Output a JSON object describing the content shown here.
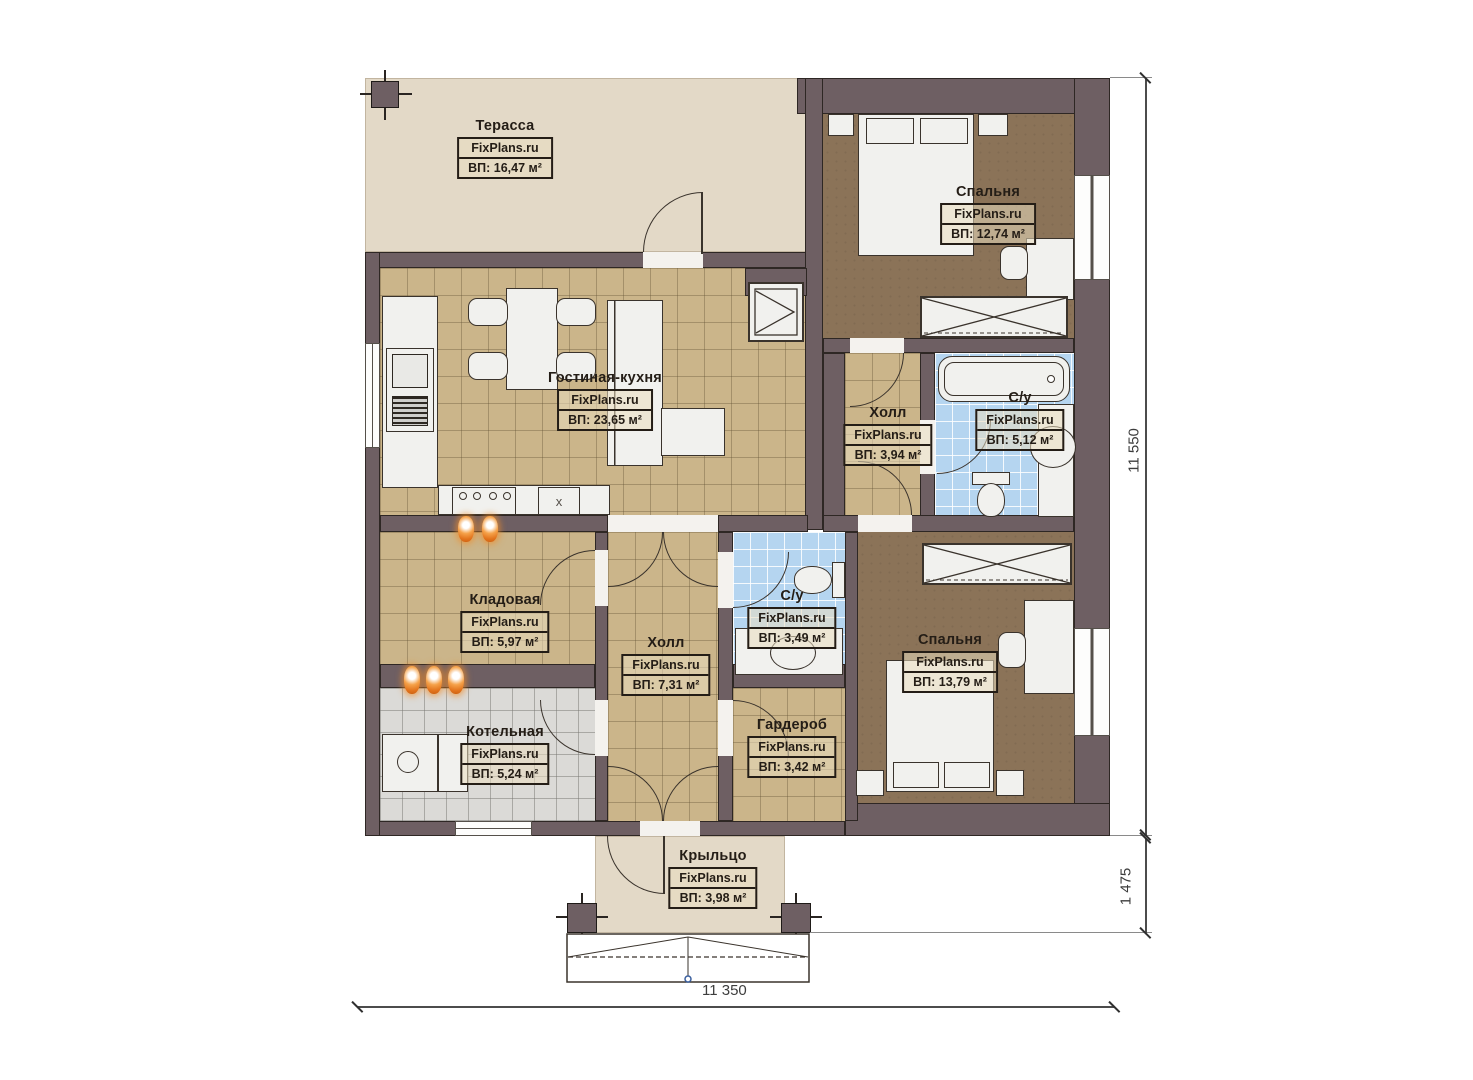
{
  "plan": {
    "rooms": [
      {
        "name": "Терасса",
        "watermark": "FixPlans.ru",
        "area": "ВП: 16,47 м²"
      },
      {
        "name": "Спальня",
        "watermark": "FixPlans.ru",
        "area": "ВП: 12,74 м²"
      },
      {
        "name": "Гостиная-кухня",
        "watermark": "FixPlans.ru",
        "area": "ВП: 23,65 м²"
      },
      {
        "name": "Холл",
        "watermark": "FixPlans.ru",
        "area": "ВП: 3,94 м²"
      },
      {
        "name": "С/у",
        "watermark": "FixPlans.ru",
        "area": "ВП: 5,12 м²"
      },
      {
        "name": "Кладовая",
        "watermark": "FixPlans.ru",
        "area": "ВП: 5,97 м²"
      },
      {
        "name": "Холл",
        "watermark": "FixPlans.ru",
        "area": "ВП: 7,31 м²"
      },
      {
        "name": "С/у",
        "watermark": "FixPlans.ru",
        "area": "ВП: 3,49 м²"
      },
      {
        "name": "Котельная",
        "watermark": "FixPlans.ru",
        "area": "ВП: 5,24 м²"
      },
      {
        "name": "Гардероб",
        "watermark": "FixPlans.ru",
        "area": "ВП: 3,42 м²"
      },
      {
        "name": "Спальня",
        "watermark": "FixPlans.ru",
        "area": "ВП: 13,79 м²"
      },
      {
        "name": "Крыльцо",
        "watermark": "FixPlans.ru",
        "area": "ВП: 3,98 м²"
      }
    ],
    "dimensions": {
      "right_total": "11 550",
      "right_porch": "1 475",
      "bottom_total": "11 350"
    },
    "labels": {
      "kitchen_sink": "x"
    },
    "colors": {
      "wall": "#6e5f63",
      "tile_tan": "#cbb58a",
      "floor_brown": "#8b7358",
      "tile_blue": "#b5d5f0",
      "tile_gray": "#dbdad7",
      "terrace_beige": "#e3d9c7",
      "radiator_orange": "#e2731c"
    }
  }
}
